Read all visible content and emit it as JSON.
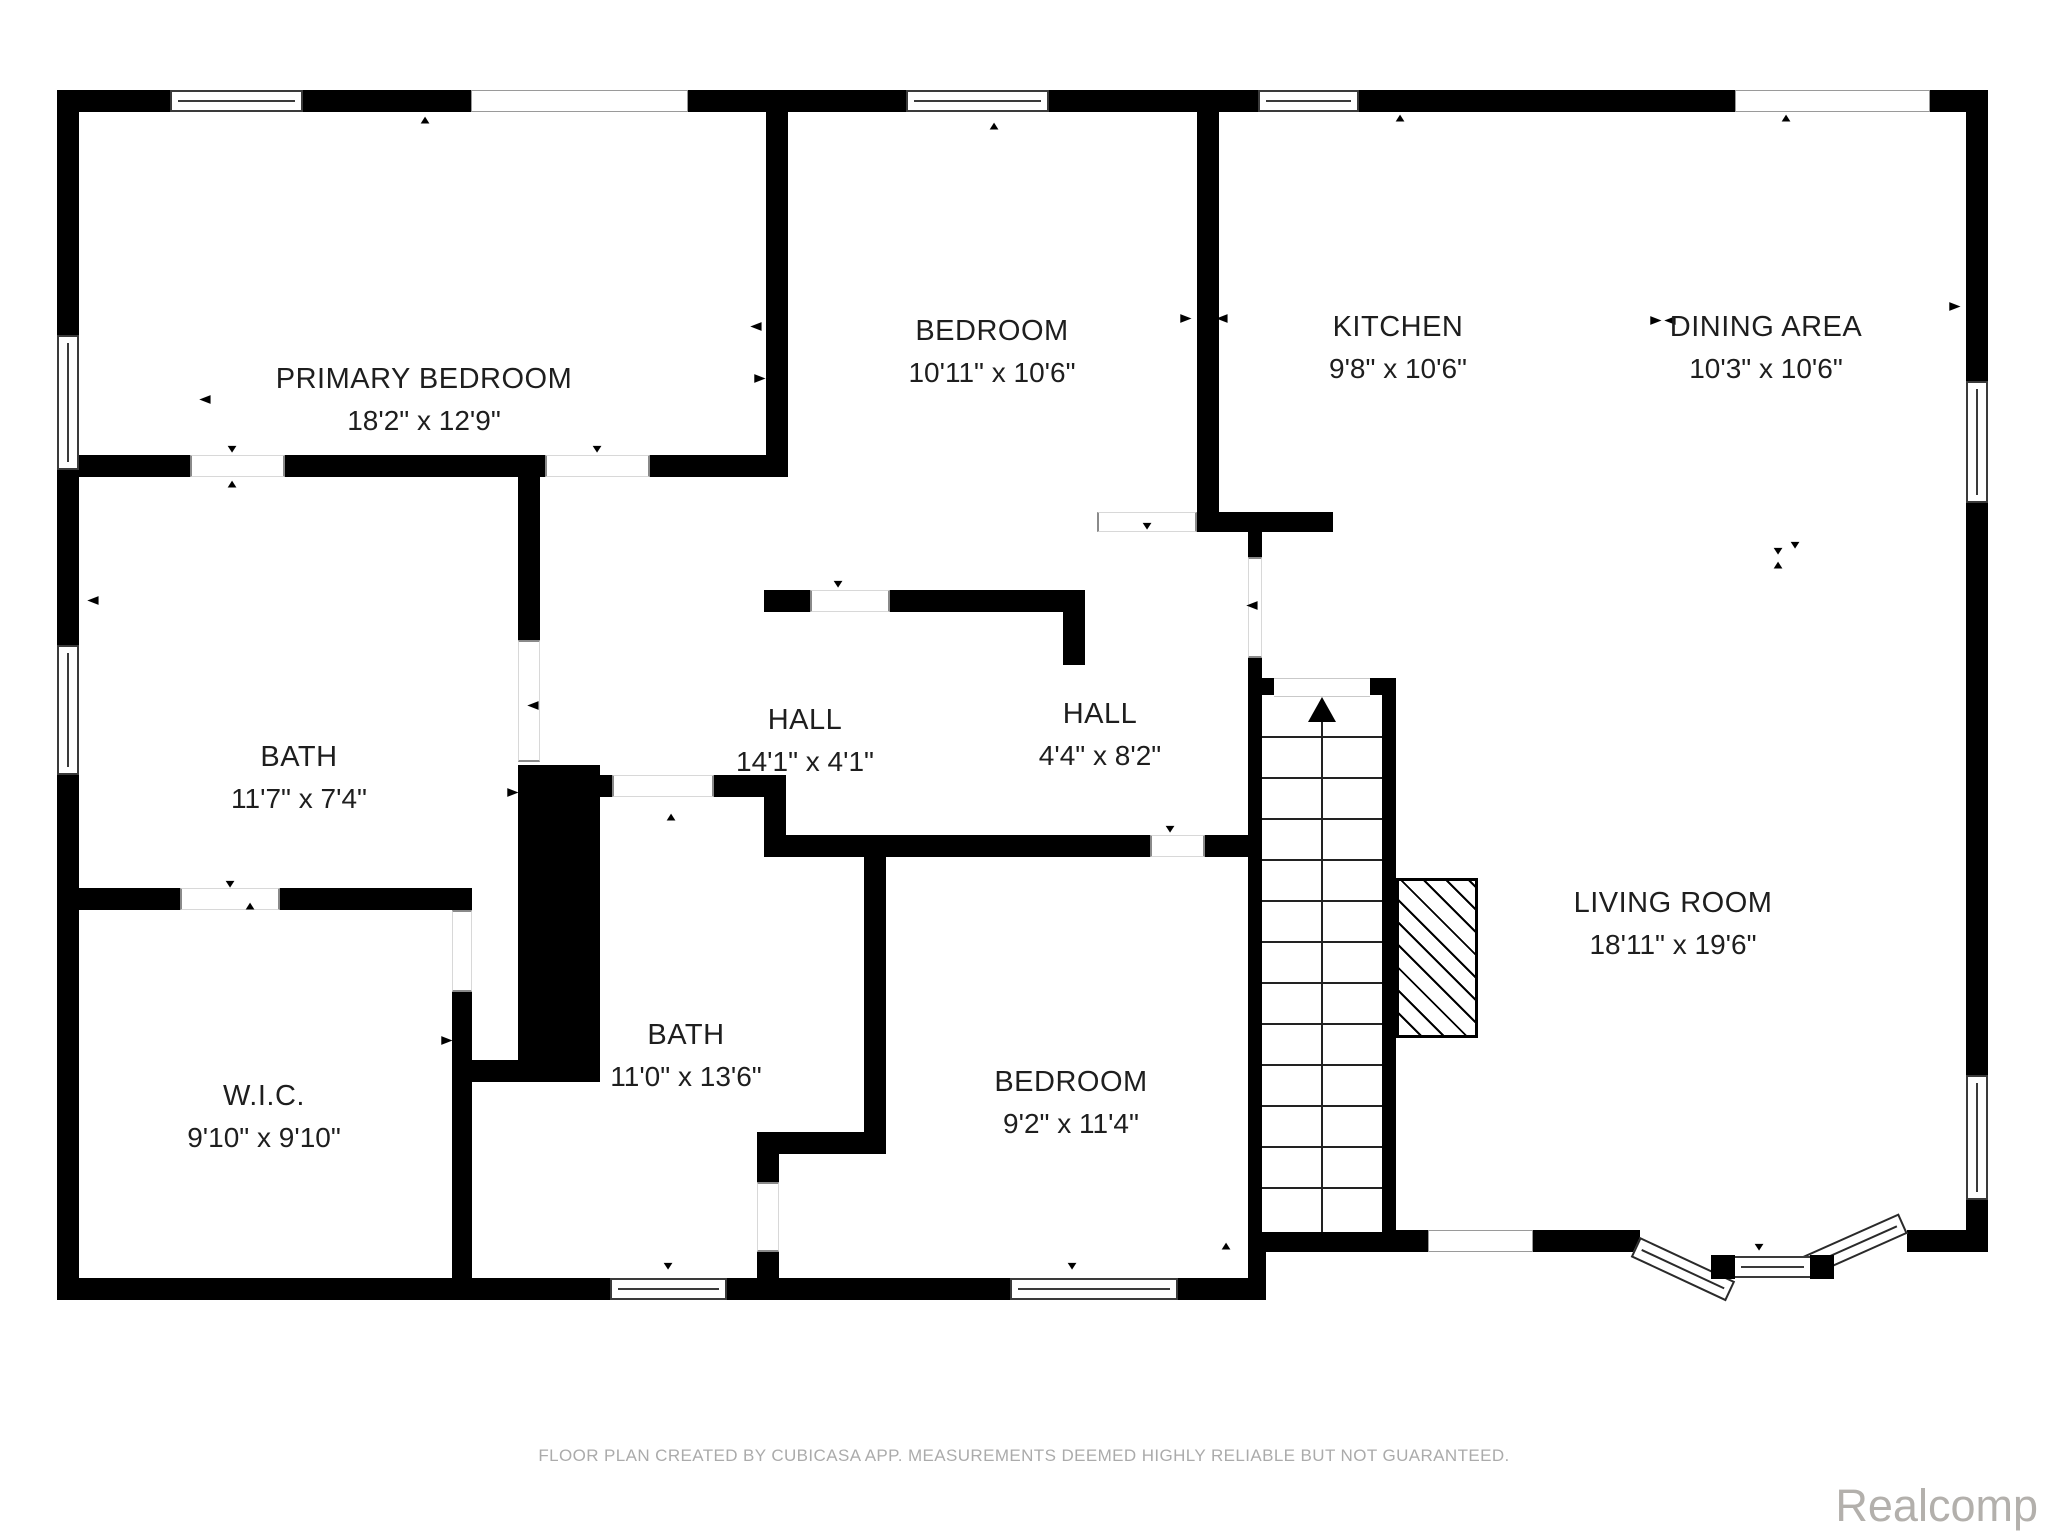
{
  "footer": {
    "disclaimer": "FLOOR PLAN CREATED BY CUBICASA APP. MEASUREMENTS DEEMED HIGHLY RELIABLE BUT NOT GUARANTEED.",
    "watermark": "Realcomp"
  },
  "colors": {
    "wall": "#000000",
    "text": "#1e1e1e",
    "muted": "#ababab",
    "watermark": "#b3b0ac"
  },
  "rooms": [
    {
      "name": "PRIMARY BEDROOM",
      "dims": "18'2\" x 12'9\"",
      "cx": 424,
      "cy": 400
    },
    {
      "name": "BEDROOM",
      "dims": "10'11\" x 10'6\"",
      "cx": 992,
      "cy": 352
    },
    {
      "name": "KITCHEN",
      "dims": "9'8\" x 10'6\"",
      "cx": 1398,
      "cy": 348
    },
    {
      "name": "DINING AREA",
      "dims": "10'3\" x 10'6\"",
      "cx": 1766,
      "cy": 348
    },
    {
      "name": "HALL",
      "dims": "14'1\" x 4'1\"",
      "cx": 805,
      "cy": 741
    },
    {
      "name": "HALL",
      "dims": "4'4\" x 8'2\"",
      "cx": 1100,
      "cy": 735
    },
    {
      "name": "BATH",
      "dims": "11'7\" x 7'4\"",
      "cx": 299,
      "cy": 778
    },
    {
      "name": "W.I.C.",
      "dims": "9'10\" x 9'10\"",
      "cx": 264,
      "cy": 1117
    },
    {
      "name": "BATH",
      "dims": "11'0\" x 13'6\"",
      "cx": 686,
      "cy": 1056
    },
    {
      "name": "BEDROOM",
      "dims": "9'2\" x 11'4\"",
      "cx": 1071,
      "cy": 1103
    },
    {
      "name": "LIVING ROOM",
      "dims": "18'11\" x 19'6\"",
      "cx": 1673,
      "cy": 924
    }
  ],
  "walls": [
    {
      "x": 57,
      "y": 90,
      "w": 1931,
      "h": 22
    },
    {
      "x": 57,
      "y": 90,
      "w": 22,
      "h": 1210
    },
    {
      "x": 1966,
      "y": 90,
      "w": 22,
      "h": 1162
    },
    {
      "x": 57,
      "y": 1278,
      "w": 1209,
      "h": 22
    },
    {
      "x": 1248,
      "y": 1230,
      "w": 392,
      "h": 22
    },
    {
      "x": 1907,
      "y": 1230,
      "w": 81,
      "h": 22
    },
    {
      "x": 1248,
      "y": 1252,
      "w": 18,
      "h": 48
    },
    {
      "x": 766,
      "y": 112,
      "w": 22,
      "h": 365
    },
    {
      "x": 57,
      "y": 455,
      "w": 731,
      "h": 22
    },
    {
      "x": 518,
      "y": 477,
      "w": 22,
      "h": 163
    },
    {
      "x": 518,
      "y": 765,
      "w": 82,
      "h": 300
    },
    {
      "x": 57,
      "y": 888,
      "w": 415,
      "h": 22
    },
    {
      "x": 452,
      "y": 992,
      "w": 20,
      "h": 286
    },
    {
      "x": 472,
      "y": 1060,
      "w": 128,
      "h": 22
    },
    {
      "x": 533,
      "y": 775,
      "w": 79,
      "h": 22
    },
    {
      "x": 714,
      "y": 775,
      "w": 72,
      "h": 22
    },
    {
      "x": 764,
      "y": 797,
      "w": 22,
      "h": 60
    },
    {
      "x": 786,
      "y": 835,
      "w": 364,
      "h": 22
    },
    {
      "x": 1205,
      "y": 835,
      "w": 45,
      "h": 22
    },
    {
      "x": 864,
      "y": 857,
      "w": 22,
      "h": 275
    },
    {
      "x": 757,
      "y": 1132,
      "w": 129,
      "h": 22
    },
    {
      "x": 757,
      "y": 1154,
      "w": 22,
      "h": 28
    },
    {
      "x": 757,
      "y": 1252,
      "w": 22,
      "h": 26
    },
    {
      "x": 764,
      "y": 590,
      "w": 46,
      "h": 22
    },
    {
      "x": 890,
      "y": 590,
      "w": 195,
      "h": 22
    },
    {
      "x": 1063,
      "y": 590,
      "w": 22,
      "h": 75
    },
    {
      "x": 1197,
      "y": 112,
      "w": 22,
      "h": 420
    },
    {
      "x": 1197,
      "y": 512,
      "w": 136,
      "h": 20
    },
    {
      "x": 1248,
      "y": 532,
      "w": 14,
      "h": 25
    },
    {
      "x": 1248,
      "y": 658,
      "w": 14,
      "h": 574
    },
    {
      "x": 1382,
      "y": 678,
      "w": 14,
      "h": 554
    },
    {
      "x": 1248,
      "y": 1232,
      "w": 180,
      "h": 20
    },
    {
      "x": 1262,
      "y": 678,
      "w": 12,
      "h": 17
    },
    {
      "x": 1370,
      "y": 678,
      "w": 12,
      "h": 17
    },
    {
      "x": 1321,
      "y": 1218,
      "w": 11,
      "h": 14
    },
    {
      "x": 1262,
      "y": 1081,
      "w": 58,
      "h": 15
    },
    {
      "x": 1330,
      "y": 1081,
      "w": 52,
      "h": 15
    }
  ],
  "windows": [
    {
      "x": 170,
      "y": 90,
      "w": 133,
      "h": 22,
      "o": "h",
      "s": "framed"
    },
    {
      "x": 471,
      "y": 90,
      "w": 217,
      "h": 22,
      "o": "h",
      "s": "plain"
    },
    {
      "x": 906,
      "y": 90,
      "w": 143,
      "h": 22,
      "o": "h",
      "s": "framed"
    },
    {
      "x": 1258,
      "y": 90,
      "w": 101,
      "h": 22,
      "o": "h",
      "s": "framed"
    },
    {
      "x": 1735,
      "y": 90,
      "w": 195,
      "h": 22,
      "o": "h",
      "s": "plain"
    },
    {
      "x": 57,
      "y": 335,
      "w": 22,
      "h": 135,
      "o": "v",
      "s": "framed"
    },
    {
      "x": 57,
      "y": 645,
      "w": 22,
      "h": 130,
      "o": "v",
      "s": "framed"
    },
    {
      "x": 1966,
      "y": 381,
      "w": 22,
      "h": 122,
      "o": "v",
      "s": "framed"
    },
    {
      "x": 1966,
      "y": 1075,
      "w": 22,
      "h": 125,
      "o": "v",
      "s": "framed"
    },
    {
      "x": 610,
      "y": 1278,
      "w": 117,
      "h": 22,
      "o": "h",
      "s": "framed"
    },
    {
      "x": 1010,
      "y": 1278,
      "w": 168,
      "h": 22,
      "o": "h",
      "s": "framed"
    },
    {
      "x": 1428,
      "y": 1230,
      "w": 105,
      "h": 22,
      "o": "h",
      "s": "plain"
    }
  ],
  "door_gaps": [
    {
      "x": 190,
      "y": 455,
      "w": 95,
      "h": 22,
      "o": "h"
    },
    {
      "x": 545,
      "y": 455,
      "w": 105,
      "h": 22,
      "o": "h"
    },
    {
      "x": 518,
      "y": 640,
      "w": 22,
      "h": 122,
      "o": "v"
    },
    {
      "x": 180,
      "y": 888,
      "w": 100,
      "h": 22,
      "o": "h"
    },
    {
      "x": 452,
      "y": 910,
      "w": 20,
      "h": 82,
      "o": "v"
    },
    {
      "x": 612,
      "y": 775,
      "w": 102,
      "h": 22,
      "o": "h"
    },
    {
      "x": 810,
      "y": 590,
      "w": 80,
      "h": 22,
      "o": "h"
    },
    {
      "x": 1150,
      "y": 835,
      "w": 55,
      "h": 22,
      "o": "h"
    },
    {
      "x": 757,
      "y": 1182,
      "w": 22,
      "h": 70,
      "o": "v"
    },
    {
      "x": 1097,
      "y": 512,
      "w": 100,
      "h": 20,
      "o": "h"
    },
    {
      "x": 1248,
      "y": 557,
      "w": 14,
      "h": 101,
      "o": "v"
    },
    {
      "x": 1262,
      "y": 1220,
      "w": 59,
      "h": 12,
      "o": "h"
    },
    {
      "x": 1332,
      "y": 1220,
      "w": 50,
      "h": 12,
      "o": "h"
    }
  ],
  "markers": [
    {
      "d": "up",
      "x": 425,
      "y": 120
    },
    {
      "d": "up",
      "x": 994,
      "y": 126
    },
    {
      "d": "up",
      "x": 1400,
      "y": 118
    },
    {
      "d": "up",
      "x": 1786,
      "y": 118
    },
    {
      "d": "down",
      "x": 232,
      "y": 449
    },
    {
      "d": "up",
      "x": 232,
      "y": 484
    },
    {
      "d": "down",
      "x": 597,
      "y": 449
    },
    {
      "d": "left",
      "x": 205,
      "y": 399
    },
    {
      "d": "left",
      "x": 756,
      "y": 326
    },
    {
      "d": "right",
      "x": 760,
      "y": 378
    },
    {
      "d": "right",
      "x": 1186,
      "y": 318
    },
    {
      "d": "left",
      "x": 1222,
      "y": 318
    },
    {
      "d": "right",
      "x": 1656,
      "y": 320
    },
    {
      "d": "left",
      "x": 1670,
      "y": 320
    },
    {
      "d": "down",
      "x": 1795,
      "y": 545
    },
    {
      "d": "down",
      "x": 1778,
      "y": 551
    },
    {
      "d": "up",
      "x": 1778,
      "y": 565
    },
    {
      "d": "right",
      "x": 1955,
      "y": 306
    },
    {
      "d": "down",
      "x": 1147,
      "y": 526
    },
    {
      "d": "left",
      "x": 1252,
      "y": 605
    },
    {
      "d": "down",
      "x": 838,
      "y": 584
    },
    {
      "d": "up",
      "x": 671,
      "y": 817
    },
    {
      "d": "down",
      "x": 230,
      "y": 884
    },
    {
      "d": "up",
      "x": 250,
      "y": 906
    },
    {
      "d": "right",
      "x": 447,
      "y": 1040
    },
    {
      "d": "down",
      "x": 1170,
      "y": 829
    },
    {
      "d": "left",
      "x": 93,
      "y": 600
    },
    {
      "d": "right",
      "x": 513,
      "y": 792
    },
    {
      "d": "left",
      "x": 533,
      "y": 705
    },
    {
      "d": "up",
      "x": 1226,
      "y": 1246
    },
    {
      "d": "down",
      "x": 668,
      "y": 1266
    },
    {
      "d": "down",
      "x": 1072,
      "y": 1266
    },
    {
      "d": "down",
      "x": 1759,
      "y": 1247
    }
  ],
  "stairs": {
    "x": 1262,
    "y": 695,
    "w": 120,
    "h": 537,
    "tread_start": 736,
    "tread_step": 41,
    "tread_count": 12,
    "center_x": 1322,
    "arrow_y": 697,
    "landing": {
      "x": 1274,
      "y": 678,
      "w": 96,
      "h": 17
    }
  },
  "fireplace": {
    "x": 1396,
    "y": 878,
    "w": 82,
    "h": 160,
    "firebox": {
      "x": 1420,
      "y": 924,
      "w": 54,
      "h": 70
    }
  },
  "bay": {
    "left_glass": {
      "x": 1640,
      "y": 1237,
      "w": 105,
      "h": 22,
      "rot": 25,
      "origin": "0 0"
    },
    "right_glass": {
      "x": 1810,
      "y": 1255,
      "w": 107,
      "h": 22,
      "rot": -24,
      "origin": "0 100%"
    },
    "center_window": {
      "x": 1733,
      "y": 1256,
      "w": 79,
      "h": 22
    },
    "jambs": [
      {
        "x": 1711,
        "y": 1255,
        "w": 24,
        "h": 24
      },
      {
        "x": 1810,
        "y": 1255,
        "w": 24,
        "h": 24
      }
    ]
  },
  "footer_layout": {
    "disclaimer_y": 1446,
    "watermark_right": 10,
    "watermark_top": 1480
  }
}
